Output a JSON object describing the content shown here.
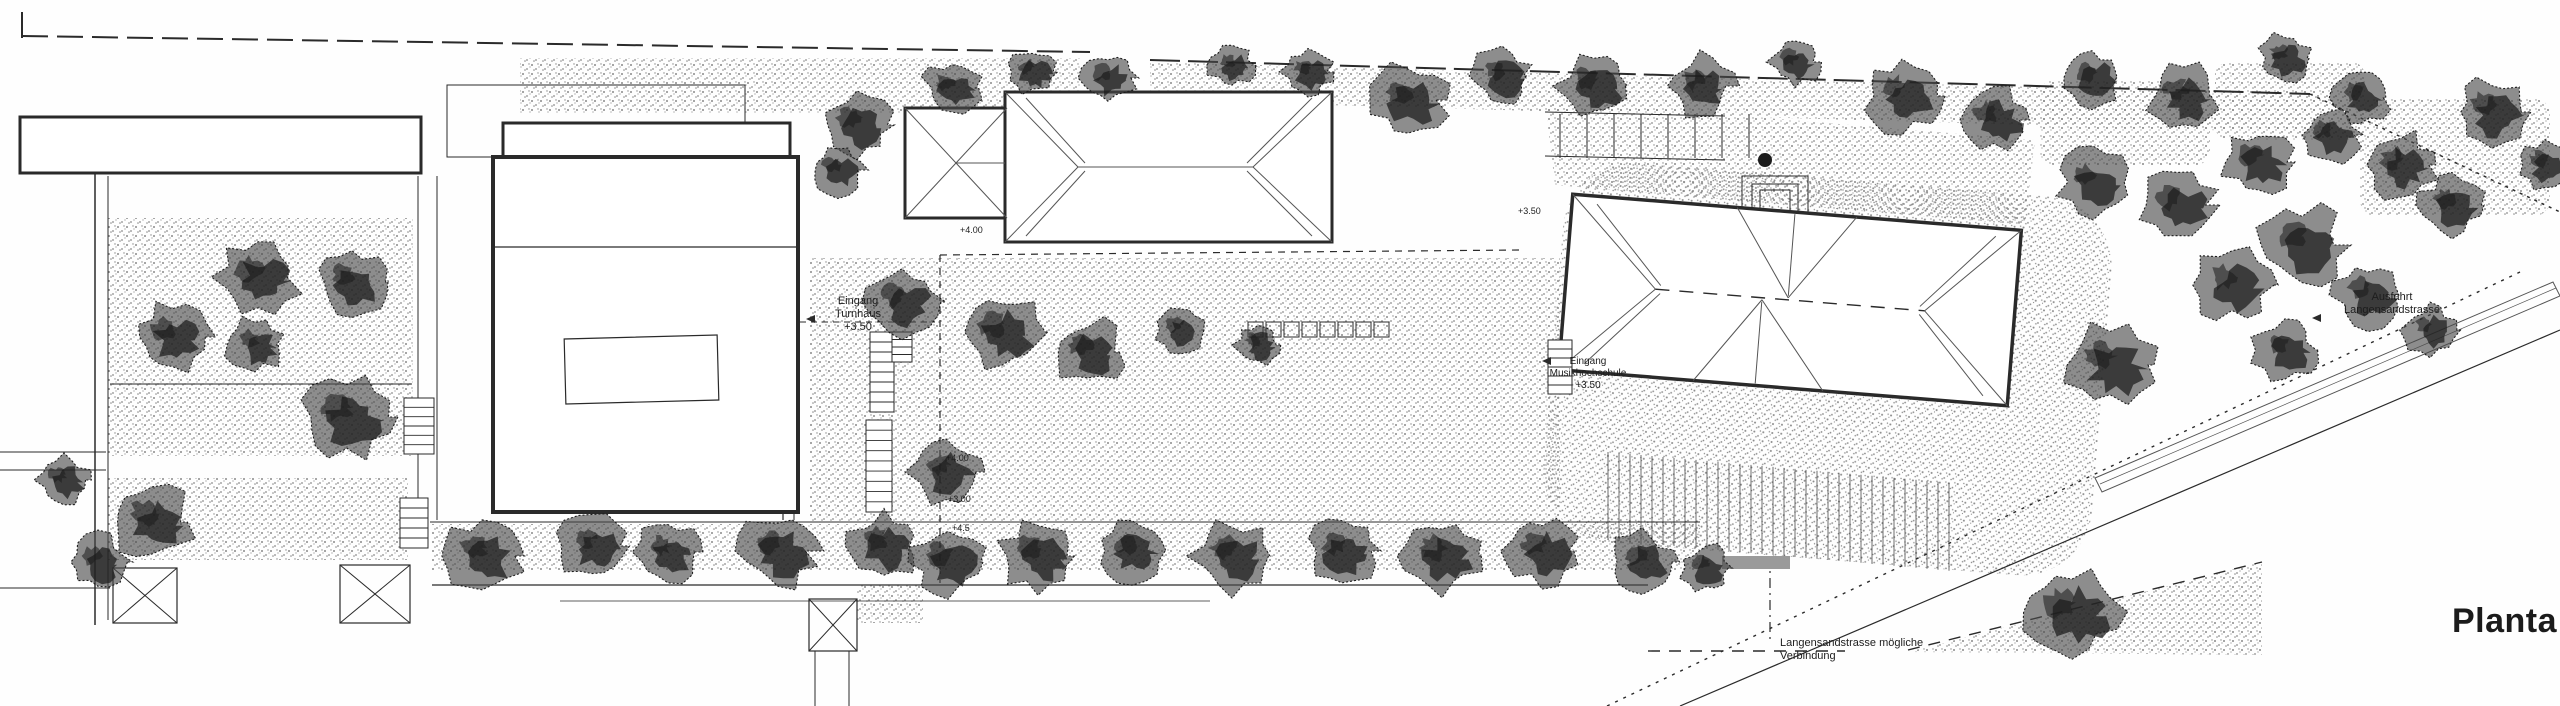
{
  "plan": {
    "title": "Planta",
    "title_pos": {
      "x": 2452,
      "y": 602,
      "size": 34
    },
    "colors": {
      "ink": "#2a2a2a",
      "ink_light": "#555555",
      "tree_dark": "#1c1c1c",
      "tree_mid": "#474747",
      "stipple_dot": "#8a8a8a",
      "paper": "#fefefe",
      "grey_bar": "#9a9a9a"
    },
    "annotations": [
      {
        "name": "entrance-gym-label",
        "lines": [
          "Eingang",
          "Turnhaus",
          "+3.50"
        ],
        "x": 858,
        "y": 304,
        "size": 11,
        "anchor": "middle"
      },
      {
        "name": "entrance-school-label",
        "lines": [
          "Eingang",
          "Musikhochschule",
          "+3.50"
        ],
        "x": 1588,
        "y": 364,
        "size": 10,
        "anchor": "middle"
      },
      {
        "name": "exit-street-label",
        "lines": [
          "Ausfahrt",
          "Langensandstrasse"
        ],
        "x": 2392,
        "y": 300,
        "size": 11,
        "anchor": "middle"
      },
      {
        "name": "possible-connection-label",
        "lines": [
          "Langensandstrasse mögliche",
          "Verbindung"
        ],
        "x": 1780,
        "y": 646,
        "size": 11,
        "anchor": "start"
      },
      {
        "name": "level-350",
        "lines": [
          "+3.50"
        ],
        "x": 1518,
        "y": 214,
        "size": 9,
        "anchor": "start"
      },
      {
        "name": "level-400-upper",
        "lines": [
          "+4.00"
        ],
        "x": 960,
        "y": 233,
        "size": 9,
        "anchor": "start"
      },
      {
        "name": "level-400",
        "lines": [
          "+4.00"
        ],
        "x": 946,
        "y": 461,
        "size": 9,
        "anchor": "start"
      },
      {
        "name": "level-300",
        "lines": [
          "+3.00"
        ],
        "x": 948,
        "y": 502,
        "size": 9,
        "anchor": "start"
      },
      {
        "name": "level-45",
        "lines": [
          "+4.5"
        ],
        "x": 952,
        "y": 531,
        "size": 9,
        "anchor": "start"
      }
    ],
    "arrows": [
      {
        "name": "gym-entrance-arrow",
        "x": 806,
        "y": 319
      },
      {
        "name": "school-entrance-arrow",
        "x": 1542,
        "y": 361
      },
      {
        "name": "exit-arrow",
        "x": 2312,
        "y": 318
      }
    ],
    "stipples": [
      {
        "x": 108,
        "y": 218,
        "w": 305,
        "h": 238
      },
      {
        "x": 108,
        "y": 478,
        "w": 300,
        "h": 82
      },
      {
        "x": 810,
        "y": 258,
        "w": 750,
        "h": 264
      },
      {
        "x": 432,
        "y": 524,
        "w": 1268,
        "h": 46
      },
      {
        "x": 520,
        "y": 58,
        "w": 560,
        "h": 55
      },
      {
        "x": 857,
        "y": 585,
        "w": 66,
        "h": 38
      },
      {
        "x": 2040,
        "y": 80,
        "w": 170,
        "h": 85,
        "rx": 14
      },
      {
        "x": 2215,
        "y": 62,
        "w": 150,
        "h": 78,
        "rx": 14
      },
      {
        "x": 2360,
        "y": 98,
        "w": 190,
        "h": 118,
        "rx": 16
      },
      {
        "poly": [
          [
            1150,
            62
          ],
          [
            2350,
            96
          ],
          [
            2350,
            134
          ],
          [
            1150,
            100
          ]
        ]
      },
      {
        "poly": [
          [
            1545,
            100
          ],
          [
            2035,
            140
          ],
          [
            2025,
            225
          ],
          [
            1555,
            185
          ]
        ]
      },
      {
        "poly": [
          [
            1908,
            652
          ],
          [
            2262,
            562
          ],
          [
            2262,
            655
          ]
        ]
      }
    ],
    "terrace": {
      "x": 1558,
      "y": 176,
      "w": 550,
      "h": 380,
      "rx": 70,
      "rot": 4.6,
      "cx": 1790,
      "cy": 300
    },
    "buildings": [
      {
        "name": "neighbor-building",
        "x": 20,
        "y": 117,
        "w": 401,
        "h": 56,
        "sw": 3
      },
      {
        "name": "gym-forecourt",
        "x": 447,
        "y": 85,
        "w": 298,
        "h": 72,
        "sw": 1,
        "nofill": true
      },
      {
        "name": "gym-north-strip",
        "x": 503,
        "y": 123,
        "w": 287,
        "h": 39,
        "sw": 3
      },
      {
        "name": "gym-hall",
        "x": 493,
        "y": 157,
        "w": 305,
        "h": 355,
        "sw": 4
      },
      {
        "name": "school-west-wing",
        "x": 905,
        "y": 108,
        "w": 102,
        "h": 110,
        "sw": 3
      },
      {
        "name": "school-main-wing",
        "x": 1005,
        "y": 92,
        "w": 327,
        "h": 150,
        "sw": 3
      },
      {
        "name": "entry-steps-outer",
        "x": 1742,
        "y": 176,
        "w": 66,
        "h": 38,
        "sw": 1,
        "nofill": true
      },
      {
        "name": "entry-steps-mid",
        "x": 1752,
        "y": 184,
        "w": 46,
        "h": 30,
        "sw": 1,
        "nofill": true
      },
      {
        "name": "entry-steps-inner",
        "x": 1760,
        "y": 190,
        "w": 30,
        "h": 24,
        "sw": 1,
        "nofill": true
      }
    ],
    "building3": {
      "name": "school-building-east",
      "x": 1565,
      "y": 212,
      "w": 450,
      "h": 176,
      "sw": 3.5,
      "rot": 4.6,
      "cx": 1790,
      "cy": 300,
      "ridge": [
        1655,
        300,
        1925,
        300
      ],
      "hips": [
        [
          1565,
          212,
          1655,
          300
        ],
        [
          1565,
          388,
          1655,
          300
        ],
        [
          2015,
          212,
          1925,
          300
        ],
        [
          2015,
          388,
          1925,
          300
        ],
        [
          1590,
          220,
          1660,
          296
        ],
        [
          1590,
          380,
          1660,
          304
        ],
        [
          1990,
          220,
          1920,
          296
        ],
        [
          1990,
          380,
          1920,
          304
        ],
        [
          1730,
          212,
          1788,
          298
        ],
        [
          1850,
          212,
          1788,
          298
        ],
        [
          1788,
          214,
          1788,
          296
        ],
        [
          1700,
          388,
          1762,
          302
        ],
        [
          1830,
          388,
          1762,
          302
        ],
        [
          1762,
          304,
          1762,
          386
        ]
      ]
    },
    "roof2": {
      "wing_point": [
        956,
        163
      ],
      "wing_corners": [
        [
          905,
          108
        ],
        [
          905,
          218
        ],
        [
          1007,
          108
        ],
        [
          1007,
          218
        ]
      ],
      "wing_ridge": [
        956,
        163,
        1005,
        163
      ],
      "main_ridge": [
        1078,
        167,
        1253,
        167
      ],
      "main_hips": [
        [
          1005,
          92,
          1078,
          167
        ],
        [
          1005,
          242,
          1078,
          167
        ],
        [
          1332,
          92,
          1253,
          167
        ],
        [
          1332,
          242,
          1253,
          167
        ],
        [
          1026,
          98,
          1085,
          163
        ],
        [
          1026,
          236,
          1085,
          171
        ],
        [
          1312,
          98,
          1247,
          163
        ],
        [
          1312,
          236,
          1247,
          171
        ]
      ]
    },
    "gym_roof": {
      "divider": [
        493,
        247,
        798,
        247
      ],
      "skylight": {
        "x": 565,
        "y": 337,
        "w": 153,
        "h": 65,
        "rot": -1.5
      }
    },
    "lines": [
      {
        "x1": 22,
        "y1": 12,
        "x2": 22,
        "y2": 38,
        "w": 2
      },
      {
        "x1": 22,
        "y1": 36,
        "x2": 1090,
        "y2": 52,
        "w": 2,
        "dash": "26 9"
      },
      {
        "x1": 1150,
        "y1": 60,
        "x2": 2310,
        "y2": 94,
        "w": 2,
        "dash": "30 8"
      },
      {
        "x1": 2310,
        "y1": 94,
        "x2": 2560,
        "y2": 212,
        "w": 1.5,
        "dash": "3 5"
      },
      {
        "x1": 95,
        "y1": 172,
        "x2": 95,
        "y2": 625,
        "w": 1.5
      },
      {
        "x1": 108,
        "y1": 176,
        "x2": 108,
        "y2": 620,
        "w": 1
      },
      {
        "x1": 0,
        "y1": 452,
        "x2": 106,
        "y2": 452,
        "w": 1
      },
      {
        "x1": 0,
        "y1": 470,
        "x2": 106,
        "y2": 470,
        "w": 1
      },
      {
        "x1": 0,
        "y1": 588,
        "x2": 110,
        "y2": 588,
        "w": 1
      },
      {
        "x1": 110,
        "y1": 384,
        "x2": 412,
        "y2": 384,
        "w": 1
      },
      {
        "x1": 418,
        "y1": 176,
        "x2": 418,
        "y2": 520,
        "w": 1
      },
      {
        "x1": 437,
        "y1": 176,
        "x2": 437,
        "y2": 520,
        "w": 1
      },
      {
        "x1": 783,
        "y1": 165,
        "x2": 783,
        "y2": 520,
        "w": 1.2
      },
      {
        "x1": 794,
        "y1": 165,
        "x2": 794,
        "y2": 520,
        "w": 1
      },
      {
        "x1": 430,
        "y1": 522,
        "x2": 1700,
        "y2": 522,
        "w": 1
      },
      {
        "x1": 432,
        "y1": 585,
        "x2": 1648,
        "y2": 585,
        "w": 1.2
      },
      {
        "x1": 560,
        "y1": 601,
        "x2": 1210,
        "y2": 601,
        "w": 0.8
      },
      {
        "x1": 940,
        "y1": 255,
        "x2": 940,
        "y2": 583,
        "w": 1.2,
        "dash": "7 6"
      },
      {
        "x1": 940,
        "y1": 255,
        "x2": 1520,
        "y2": 250,
        "w": 1.2,
        "dash": "7 6"
      },
      {
        "x1": 800,
        "y1": 322,
        "x2": 935,
        "y2": 322,
        "w": 1,
        "dash": "6 5"
      },
      {
        "x1": 815,
        "y1": 651,
        "x2": 815,
        "y2": 706,
        "w": 1
      },
      {
        "x1": 849,
        "y1": 651,
        "x2": 849,
        "y2": 706,
        "w": 1
      },
      {
        "x1": 1545,
        "y1": 112,
        "x2": 1725,
        "y2": 116,
        "w": 1
      },
      {
        "x1": 1545,
        "y1": 156,
        "x2": 1725,
        "y2": 160,
        "w": 1
      },
      {
        "x1": 1607,
        "y1": 706,
        "x2": 2520,
        "y2": 272,
        "w": 1.4,
        "dash": "3 6"
      },
      {
        "x1": 1680,
        "y1": 706,
        "x2": 2560,
        "y2": 330,
        "w": 1.2
      },
      {
        "x1": 1648,
        "y1": 651,
        "x2": 1845,
        "y2": 651,
        "w": 1.4,
        "dash": "12 9"
      },
      {
        "x1": 1908,
        "y1": 650,
        "x2": 2262,
        "y2": 562,
        "w": 1.4,
        "dash": "12 9"
      },
      {
        "x1": 1770,
        "y1": 556,
        "x2": 1770,
        "y2": 640,
        "w": 1.2,
        "dash": "10 5 2 5"
      }
    ],
    "ramp": {
      "outer": [
        [
          2095,
          478
        ],
        [
          2553,
          282
        ],
        [
          2560,
          296
        ],
        [
          2102,
          492
        ]
      ],
      "inner": [
        2100,
        484,
        2556,
        288
      ]
    },
    "grey_bar": {
      "x": 1722,
      "y": 556,
      "w": 68,
      "h": 13
    },
    "small_blob": {
      "x": 1765,
      "y": 160,
      "r": 7
    },
    "parking": {
      "x0": 1560,
      "y0": 114,
      "step": 27,
      "n": 7,
      "len": 44
    },
    "hedges": {
      "x0": 1248,
      "y0": 322,
      "size": 15,
      "gap": 3,
      "n": 8
    },
    "colonnade": {
      "x0": 1608,
      "y0": 452,
      "dx": 11,
      "n": 32,
      "len": 88,
      "slope": 0.09
    },
    "stairs": [
      {
        "x": 870,
        "y": 332,
        "w": 24,
        "h": 80,
        "n": 8
      },
      {
        "x": 866,
        "y": 420,
        "w": 26,
        "h": 92,
        "n": 9
      },
      {
        "x": 892,
        "y": 332,
        "w": 20,
        "h": 30,
        "n": 4
      },
      {
        "x": 404,
        "y": 398,
        "w": 30,
        "h": 56,
        "n": 6
      },
      {
        "x": 400,
        "y": 498,
        "w": 28,
        "h": 50,
        "n": 5
      },
      {
        "x": 1548,
        "y": 340,
        "w": 24,
        "h": 54,
        "n": 6
      }
    ],
    "xboxes": [
      {
        "x": 113,
        "y": 568,
        "w": 64,
        "h": 55
      },
      {
        "x": 340,
        "y": 565,
        "w": 70,
        "h": 58
      },
      {
        "x": 809,
        "y": 599,
        "w": 48,
        "h": 52
      }
    ],
    "trees": [
      [
        857,
        125,
        40
      ],
      [
        952,
        88,
        32
      ],
      [
        1032,
        72,
        28
      ],
      [
        1108,
        78,
        30
      ],
      [
        1232,
        66,
        26
      ],
      [
        1308,
        72,
        28
      ],
      [
        1408,
        100,
        44
      ],
      [
        1502,
        76,
        34
      ],
      [
        1594,
        86,
        40
      ],
      [
        1700,
        86,
        38
      ],
      [
        1795,
        62,
        28
      ],
      [
        1902,
        96,
        45
      ],
      [
        1994,
        120,
        40
      ],
      [
        2092,
        78,
        34
      ],
      [
        2184,
        96,
        40
      ],
      [
        2285,
        58,
        30
      ],
      [
        2360,
        98,
        32
      ],
      [
        2492,
        112,
        42
      ],
      [
        2545,
        165,
        30
      ],
      [
        2093,
        182,
        40
      ],
      [
        2178,
        205,
        42
      ],
      [
        2258,
        162,
        40
      ],
      [
        2330,
        135,
        34
      ],
      [
        2400,
        165,
        40
      ],
      [
        2452,
        205,
        36
      ],
      [
        2302,
        245,
        48
      ],
      [
        2232,
        285,
        44
      ],
      [
        2368,
        295,
        40
      ],
      [
        2430,
        330,
        30
      ],
      [
        2285,
        350,
        36
      ],
      [
        2110,
        365,
        52
      ],
      [
        258,
        277,
        46
      ],
      [
        352,
        282,
        40
      ],
      [
        172,
        337,
        42
      ],
      [
        255,
        345,
        34
      ],
      [
        347,
        417,
        50
      ],
      [
        152,
        522,
        46
      ],
      [
        98,
        562,
        34
      ],
      [
        64,
        480,
        30
      ],
      [
        902,
        302,
        42
      ],
      [
        1002,
        332,
        46
      ],
      [
        1088,
        352,
        40
      ],
      [
        946,
        472,
        40
      ],
      [
        1180,
        330,
        30
      ],
      [
        1258,
        345,
        26
      ],
      [
        838,
        170,
        30
      ],
      [
        482,
        556,
        44
      ],
      [
        592,
        546,
        40
      ],
      [
        668,
        552,
        36
      ],
      [
        778,
        551,
        44
      ],
      [
        884,
        546,
        40
      ],
      [
        948,
        562,
        42
      ],
      [
        1038,
        556,
        44
      ],
      [
        1132,
        551,
        38
      ],
      [
        1232,
        556,
        44
      ],
      [
        1342,
        551,
        40
      ],
      [
        1442,
        556,
        44
      ],
      [
        1542,
        551,
        40
      ],
      [
        1642,
        562,
        36
      ],
      [
        1706,
        568,
        28
      ],
      [
        2072,
        612,
        54
      ]
    ]
  }
}
